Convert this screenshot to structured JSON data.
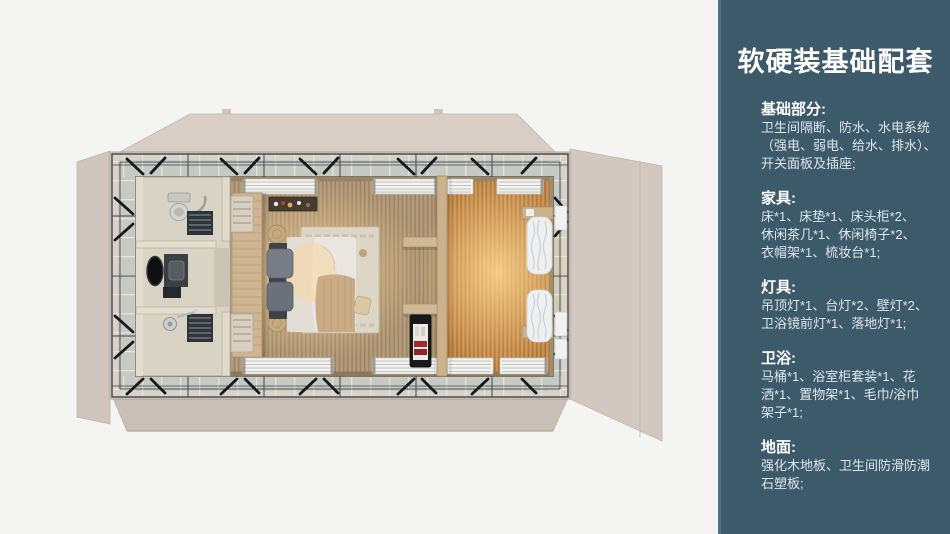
{
  "sidebar": {
    "title": "软硬装基础配套",
    "sections": [
      {
        "heading": "基础部分:",
        "lines": [
          "卫生间隔断、防水、水电系统",
          "（强电、弱电、给水、排水）、",
          "开关面板及插座;"
        ]
      },
      {
        "heading": "家具:",
        "lines": [
          "床*1、床垫*1、床头柜*2、",
          "休闲茶几*1、休闲椅子*2、",
          "衣帽架*1、梳妆台*1;"
        ]
      },
      {
        "heading": "灯具:",
        "lines": [
          "吊顶灯*1、台灯*2、壁灯*2、",
          "卫浴镜前灯*1、落地灯*1;"
        ]
      },
      {
        "heading": "卫浴:",
        "lines": [
          "马桶*1、浴室柜套装*1、花",
          "洒*1、置物架*1、毛巾/浴巾",
          "架子*1;"
        ]
      },
      {
        "heading": "地面:",
        "lines": [
          "强化木地板、卫生间防滑防潮",
          "石塑板;"
        ]
      }
    ]
  },
  "colors": {
    "sidebar_bg": "#3d5a6b",
    "sidebar_edge": "#52707f",
    "sidebar_heading": "#ffffff",
    "sidebar_text": "#dfe6ea",
    "canvas_bg": "#f4f5f3",
    "flap": "#d5cbc2",
    "deck": "#c6cac3",
    "frame": "#3f464e",
    "floor_wood": "#b29a77",
    "floor_warm": "#c68d4f",
    "bathroom": "#d9d3c6",
    "bed_duvet": "#eae7e1"
  }
}
